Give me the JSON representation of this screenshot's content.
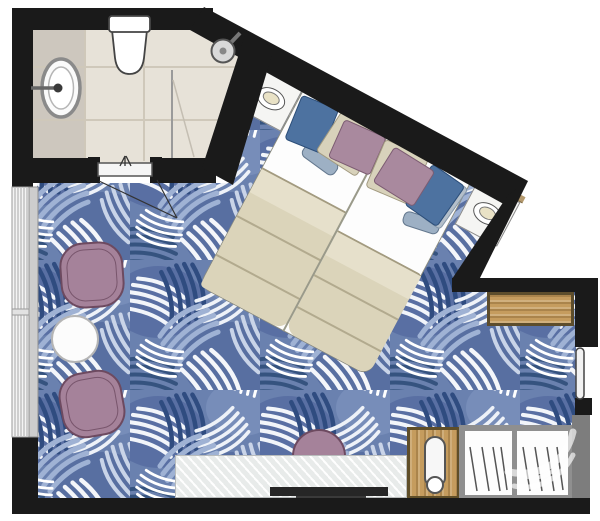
{
  "plan": {
    "kind": "hotel-guestroom-floorplan",
    "rooms": [
      {
        "name": "bathroom",
        "floor": "beige-tile",
        "fixtures": [
          "toilet",
          "round-sink",
          "shower-head",
          "glass-partition",
          "sliding-door"
        ]
      },
      {
        "name": "bedroom",
        "floor": "blue-leaf-carpet",
        "furniture": [
          "double-bed-two-mattresses",
          "headboard-ledge",
          "nightstand-left",
          "nightstand-right",
          "lounge-chair-upper",
          "lounge-chair-lower",
          "round-side-table",
          "window-with-louvers",
          "tv-counter",
          "tv",
          "half-round-stool",
          "minibar-cabinet",
          "wardrobe-two-sections-with-hangers",
          "wood-shelf",
          "entry-door"
        ]
      }
    ],
    "colors": {
      "wall": "#1a1a1a",
      "wall-light": "#7d7d7d",
      "tile": "#e7e2d8",
      "vanity": "#cdc7be",
      "grout": "#cfc8ba",
      "carpet-base": "#6a81af",
      "carpet-dark": "#31497e",
      "carpet-mid": "#51689f",
      "carpet-light": "#9fb2d4",
      "carpet-white": "#f4f6fa",
      "wood": "#c59c5e",
      "wood-strip": "#b59a6e",
      "mauve": "#a5829a",
      "mauve-dark": "#6d4a60",
      "pillow-blue": "#4d72a0",
      "pillow-beige": "#d8d2bb",
      "pillow-mauve": "#a9899e",
      "bolster": "#9db0c4",
      "blanket": "#dbd4ba",
      "blanket-light": "#e6e0cb",
      "counter": "#eef0ef",
      "tv": "#262626"
    }
  }
}
